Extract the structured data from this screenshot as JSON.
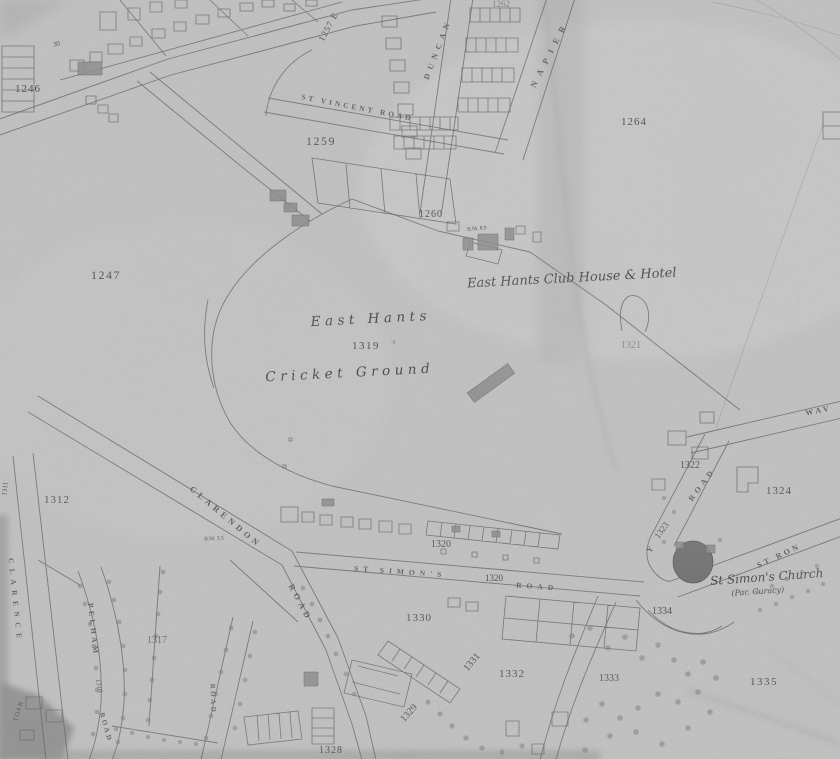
{
  "map": {
    "kind": "scanned historic Ordnance Survey town plan",
    "labels": {
      "parcels": [
        "30",
        "1246",
        "1247",
        "1257 E",
        "1259",
        "1260",
        "1262",
        "1264",
        "1311",
        "1312",
        "1317",
        "1319",
        "·9",
        "1320",
        "1320",
        "1321",
        "1322",
        "1324",
        "1328",
        "1329",
        "1330",
        "1331",
        "1332",
        "1333",
        "1334",
        "1335",
        "1314 R",
        "1310",
        "1323"
      ],
      "roads": [
        "ST VINCENT ROAD",
        "DUNCAN",
        "NAPIER",
        "CLARENDON",
        "ROAD",
        "ST SIMON'S",
        "ROAD",
        "PELHAM",
        "ROAD",
        "CLARENCE",
        "ROAD",
        "Y",
        "ROAD",
        "WAV",
        "ST RON"
      ],
      "features": [
        "East Hants",
        "Cricket Ground",
        "East Hants Club House & Hotel",
        "St Simon's Church",
        "(Par. Curacy)"
      ],
      "benchmarks": [
        "B.M. 8.9",
        "B.M. 3.5"
      ]
    },
    "colors": {
      "paper": "#c7c7c7",
      "ink": "#4f4f4f",
      "label_ink": "#474747",
      "church_fill": "#6d6d6d",
      "building_fill": "#8a8a8a"
    }
  }
}
